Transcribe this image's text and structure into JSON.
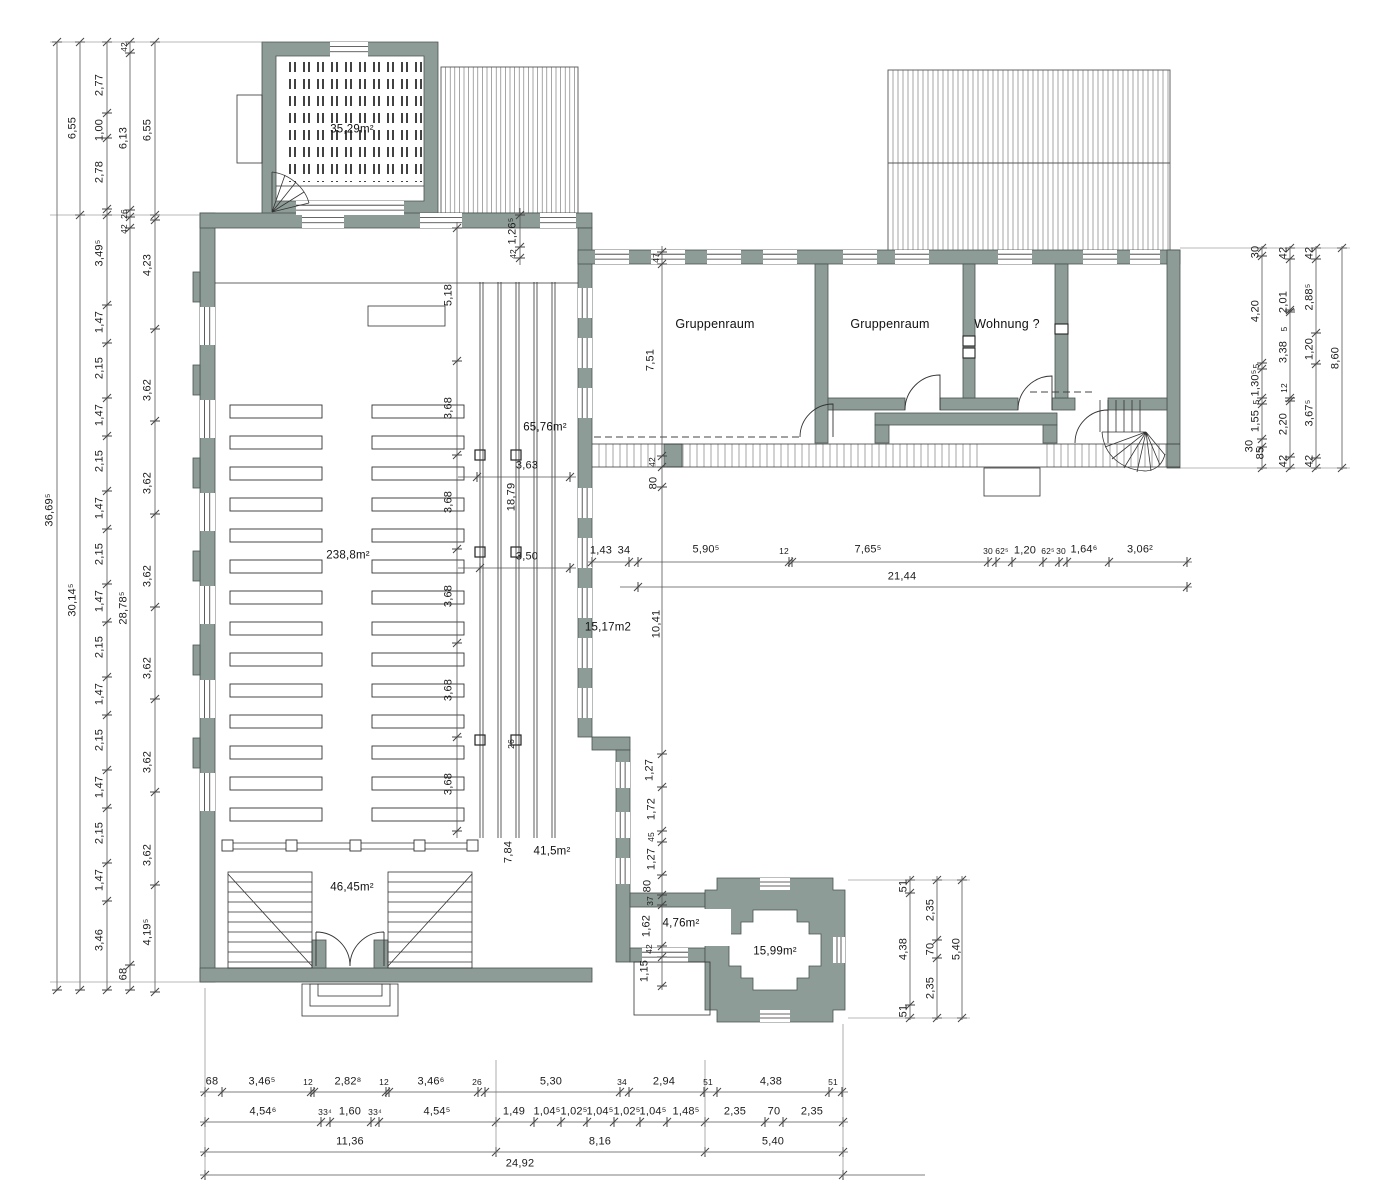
{
  "colors": {
    "wall": "#8e9c98",
    "wall_edge": "#49534f",
    "line": "#333333",
    "dim": "#555555",
    "hatch": "#6b6b6b"
  },
  "plan": {
    "rooms": [
      {
        "t": "Gruppenraum",
        "x": 715,
        "y": 324
      },
      {
        "t": "Gruppenraum",
        "x": 890,
        "y": 324
      },
      {
        "t": "Wohnung ?",
        "x": 1007,
        "y": 324
      }
    ],
    "areas": [
      {
        "t": "35,29m²",
        "x": 352,
        "y": 130
      },
      {
        "t": "238,8m²",
        "x": 348,
        "y": 556
      },
      {
        "t": "65,76m²",
        "x": 545,
        "y": 428
      },
      {
        "t": "15,17m2",
        "x": 608,
        "y": 628
      },
      {
        "t": "41,5m²",
        "x": 552,
        "y": 852
      },
      {
        "t": "46,45m²",
        "x": 352,
        "y": 888
      },
      {
        "t": "4,76m²",
        "x": 681,
        "y": 924
      },
      {
        "t": "15,99m²",
        "x": 775,
        "y": 952
      }
    ],
    "dims": [
      {
        "t": "36,69⁵",
        "x": 50,
        "y": 510,
        "v": 1
      },
      {
        "t": "6,55",
        "x": 73,
        "y": 128,
        "v": 1
      },
      {
        "t": "30,14⁵",
        "x": 73,
        "y": 600,
        "v": 1
      },
      {
        "t": "2,77",
        "x": 100,
        "y": 85,
        "v": 1
      },
      {
        "t": "1,00",
        "x": 100,
        "y": 130,
        "v": 1
      },
      {
        "t": "2,78",
        "x": 100,
        "y": 172,
        "v": 1
      },
      {
        "t": "3,49⁵",
        "x": 100,
        "y": 253,
        "v": 1
      },
      {
        "t": "1,47",
        "x": 100,
        "y": 322,
        "v": 1
      },
      {
        "t": "2,15",
        "x": 100,
        "y": 368,
        "v": 1
      },
      {
        "t": "1,47",
        "x": 100,
        "y": 415,
        "v": 1
      },
      {
        "t": "2,15",
        "x": 100,
        "y": 461,
        "v": 1
      },
      {
        "t": "1,47",
        "x": 100,
        "y": 508,
        "v": 1
      },
      {
        "t": "2,15",
        "x": 100,
        "y": 554,
        "v": 1
      },
      {
        "t": "1,47",
        "x": 100,
        "y": 601,
        "v": 1
      },
      {
        "t": "2,15",
        "x": 100,
        "y": 647,
        "v": 1
      },
      {
        "t": "1,47",
        "x": 100,
        "y": 694,
        "v": 1
      },
      {
        "t": "2,15",
        "x": 100,
        "y": 740,
        "v": 1
      },
      {
        "t": "1,47",
        "x": 100,
        "y": 787,
        "v": 1
      },
      {
        "t": "2,15",
        "x": 100,
        "y": 833,
        "v": 1
      },
      {
        "t": "1,47",
        "x": 100,
        "y": 880,
        "v": 1
      },
      {
        "t": "3,46",
        "x": 100,
        "y": 940,
        "v": 1
      },
      {
        "t": "42",
        "x": 124,
        "y": 47,
        "v": 1,
        "s": 1
      },
      {
        "t": "6,13",
        "x": 124,
        "y": 138,
        "v": 1
      },
      {
        "t": "26",
        "x": 124,
        "y": 214,
        "v": 1,
        "s": 1
      },
      {
        "t": "42",
        "x": 124,
        "y": 229,
        "v": 1,
        "s": 1
      },
      {
        "t": "28,78⁵",
        "x": 124,
        "y": 608,
        "v": 1
      },
      {
        "t": "68",
        "x": 124,
        "y": 974,
        "v": 1
      },
      {
        "t": "6,55",
        "x": 148,
        "y": 130,
        "v": 1
      },
      {
        "t": "4,23",
        "x": 148,
        "y": 265,
        "v": 1
      },
      {
        "t": "3,62",
        "x": 148,
        "y": 390,
        "v": 1
      },
      {
        "t": "3,62",
        "x": 148,
        "y": 483,
        "v": 1
      },
      {
        "t": "3,62",
        "x": 148,
        "y": 576,
        "v": 1
      },
      {
        "t": "3,62",
        "x": 148,
        "y": 668,
        "v": 1
      },
      {
        "t": "3,62",
        "x": 148,
        "y": 762,
        "v": 1
      },
      {
        "t": "3,62",
        "x": 148,
        "y": 855,
        "v": 1
      },
      {
        "t": "4,19⁵",
        "x": 148,
        "y": 932,
        "v": 1
      },
      {
        "t": "1,26⁵",
        "x": 513,
        "y": 231,
        "v": 1
      },
      {
        "t": "42",
        "x": 513,
        "y": 254,
        "v": 1,
        "s": 1
      },
      {
        "t": "5,18",
        "x": 449,
        "y": 295,
        "v": 1
      },
      {
        "t": "3,68",
        "x": 449,
        "y": 408,
        "v": 1
      },
      {
        "t": "3,68",
        "x": 449,
        "y": 502,
        "v": 1
      },
      {
        "t": "3,68",
        "x": 449,
        "y": 596,
        "v": 1
      },
      {
        "t": "3,68",
        "x": 449,
        "y": 690,
        "v": 1
      },
      {
        "t": "3,68",
        "x": 449,
        "y": 784,
        "v": 1
      },
      {
        "t": "3,63",
        "x": 527,
        "y": 466
      },
      {
        "t": "18,79",
        "x": 512,
        "y": 497,
        "v": 1
      },
      {
        "t": "3,50",
        "x": 527,
        "y": 557
      },
      {
        "t": "26",
        "x": 511,
        "y": 744,
        "v": 1,
        "s": 1
      },
      {
        "t": "7,84",
        "x": 509,
        "y": 852,
        "v": 1
      },
      {
        "t": "47",
        "x": 656,
        "y": 258,
        "v": 1,
        "s": 1
      },
      {
        "t": "7,51",
        "x": 651,
        "y": 360,
        "v": 1
      },
      {
        "t": "42",
        "x": 652,
        "y": 462,
        "v": 1,
        "s": 1
      },
      {
        "t": "80",
        "x": 654,
        "y": 483,
        "v": 1
      },
      {
        "t": "10,41",
        "x": 657,
        "y": 624,
        "v": 1
      },
      {
        "t": "1,27",
        "x": 650,
        "y": 770,
        "v": 1
      },
      {
        "t": "1,72",
        "x": 652,
        "y": 809,
        "v": 1
      },
      {
        "t": "45",
        "x": 651,
        "y": 837,
        "v": 1,
        "s": 1
      },
      {
        "t": "1,27",
        "x": 652,
        "y": 859,
        "v": 1
      },
      {
        "t": "80",
        "x": 648,
        "y": 886,
        "v": 1
      },
      {
        "t": "37",
        "x": 650,
        "y": 901,
        "v": 1,
        "s": 1
      },
      {
        "t": "1,62",
        "x": 647,
        "y": 926,
        "v": 1
      },
      {
        "t": "42",
        "x": 649,
        "y": 949,
        "v": 1,
        "s": 1
      },
      {
        "t": "1,15",
        "x": 645,
        "y": 971,
        "v": 1
      },
      {
        "t": "1,43",
        "x": 601,
        "y": 551
      },
      {
        "t": "34",
        "x": 624,
        "y": 551
      },
      {
        "t": "5,90⁵",
        "x": 706,
        "y": 550
      },
      {
        "t": "12",
        "x": 784,
        "y": 551,
        "s": 1
      },
      {
        "t": "7,65⁵",
        "x": 868,
        "y": 550
      },
      {
        "t": "30",
        "x": 988,
        "y": 551,
        "s": 1
      },
      {
        "t": "62⁵",
        "x": 1002,
        "y": 551,
        "s": 1
      },
      {
        "t": "1,20",
        "x": 1025,
        "y": 551
      },
      {
        "t": "62⁵",
        "x": 1048,
        "y": 551,
        "s": 1
      },
      {
        "t": "30",
        "x": 1061,
        "y": 551,
        "s": 1
      },
      {
        "t": "1,64⁶",
        "x": 1084,
        "y": 550
      },
      {
        "t": "3,06²",
        "x": 1140,
        "y": 550
      },
      {
        "t": "21,44",
        "x": 902,
        "y": 577
      },
      {
        "t": "30",
        "x": 1256,
        "y": 252,
        "v": 1
      },
      {
        "t": "4,20",
        "x": 1256,
        "y": 311,
        "v": 1
      },
      {
        "t": "5",
        "x": 1256,
        "y": 366,
        "v": 1,
        "s": 1
      },
      {
        "t": "1,30⁵",
        "x": 1256,
        "y": 383,
        "v": 1
      },
      {
        "t": "5",
        "x": 1256,
        "y": 402,
        "v": 1,
        "s": 1
      },
      {
        "t": "1,55",
        "x": 1256,
        "y": 421,
        "v": 1
      },
      {
        "t": "30",
        "x": 1250,
        "y": 446,
        "v": 1
      },
      {
        "t": "85",
        "x": 1261,
        "y": 453,
        "v": 1
      },
      {
        "t": "42",
        "x": 1284,
        "y": 253,
        "v": 1
      },
      {
        "t": "2,01",
        "x": 1284,
        "y": 302,
        "v": 1
      },
      {
        "t": "5",
        "x": 1284,
        "y": 329,
        "v": 1,
        "s": 1
      },
      {
        "t": "3,38",
        "x": 1284,
        "y": 352,
        "v": 1
      },
      {
        "t": "12",
        "x": 1284,
        "y": 388,
        "v": 1,
        "s": 1
      },
      {
        "t": "2,20",
        "x": 1284,
        "y": 424,
        "v": 1
      },
      {
        "t": "42",
        "x": 1284,
        "y": 461,
        "v": 1
      },
      {
        "t": "42",
        "x": 1310,
        "y": 253,
        "v": 1
      },
      {
        "t": "2,88⁵",
        "x": 1310,
        "y": 297,
        "v": 1
      },
      {
        "t": "1,20",
        "x": 1310,
        "y": 349,
        "v": 1
      },
      {
        "t": "3,67⁵",
        "x": 1310,
        "y": 413,
        "v": 1
      },
      {
        "t": "42",
        "x": 1310,
        "y": 461,
        "v": 1
      },
      {
        "t": "8,60",
        "x": 1336,
        "y": 358,
        "v": 1
      },
      {
        "t": "51",
        "x": 904,
        "y": 886,
        "v": 1
      },
      {
        "t": "4,38",
        "x": 904,
        "y": 949,
        "v": 1
      },
      {
        "t": "51",
        "x": 904,
        "y": 1011,
        "v": 1
      },
      {
        "t": "2,35",
        "x": 931,
        "y": 910,
        "v": 1
      },
      {
        "t": "70",
        "x": 931,
        "y": 949,
        "v": 1
      },
      {
        "t": "2,35",
        "x": 931,
        "y": 988,
        "v": 1
      },
      {
        "t": "5,40",
        "x": 957,
        "y": 949,
        "v": 1
      },
      {
        "t": "68",
        "x": 212,
        "y": 1082
      },
      {
        "t": "3,46⁵",
        "x": 262,
        "y": 1082
      },
      {
        "t": "12",
        "x": 308,
        "y": 1082,
        "s": 1
      },
      {
        "t": "2,82⁸",
        "x": 348,
        "y": 1082
      },
      {
        "t": "12",
        "x": 384,
        "y": 1082,
        "s": 1
      },
      {
        "t": "3,46⁶",
        "x": 431,
        "y": 1082
      },
      {
        "t": "26",
        "x": 477,
        "y": 1082,
        "s": 1
      },
      {
        "t": "5,30",
        "x": 551,
        "y": 1082
      },
      {
        "t": "34",
        "x": 622,
        "y": 1082,
        "s": 1
      },
      {
        "t": "2,94",
        "x": 664,
        "y": 1082
      },
      {
        "t": "51",
        "x": 708,
        "y": 1082,
        "s": 1
      },
      {
        "t": "4,38",
        "x": 771,
        "y": 1082
      },
      {
        "t": "51",
        "x": 833,
        "y": 1082,
        "s": 1
      },
      {
        "t": "4,54⁶",
        "x": 263,
        "y": 1112
      },
      {
        "t": "33⁴",
        "x": 325,
        "y": 1112,
        "s": 1
      },
      {
        "t": "1,60",
        "x": 350,
        "y": 1112
      },
      {
        "t": "33⁴",
        "x": 375,
        "y": 1112,
        "s": 1
      },
      {
        "t": "4,54⁵",
        "x": 437,
        "y": 1112
      },
      {
        "t": "1,49",
        "x": 514,
        "y": 1112
      },
      {
        "t": "1,04⁵",
        "x": 547,
        "y": 1112
      },
      {
        "t": "1,02⁵",
        "x": 574,
        "y": 1112
      },
      {
        "t": "1,04⁵",
        "x": 600,
        "y": 1112
      },
      {
        "t": "1,02⁵",
        "x": 627,
        "y": 1112
      },
      {
        "t": "1,04⁵",
        "x": 653,
        "y": 1112
      },
      {
        "t": "1,48⁵",
        "x": 686,
        "y": 1112
      },
      {
        "t": "2,35",
        "x": 735,
        "y": 1112
      },
      {
        "t": "70",
        "x": 774,
        "y": 1112
      },
      {
        "t": "2,35",
        "x": 812,
        "y": 1112
      },
      {
        "t": "11,36",
        "x": 350,
        "y": 1142
      },
      {
        "t": "8,16",
        "x": 600,
        "y": 1142
      },
      {
        "t": "5,40",
        "x": 773,
        "y": 1142
      },
      {
        "t": "24,92",
        "x": 520,
        "y": 1164
      }
    ]
  }
}
